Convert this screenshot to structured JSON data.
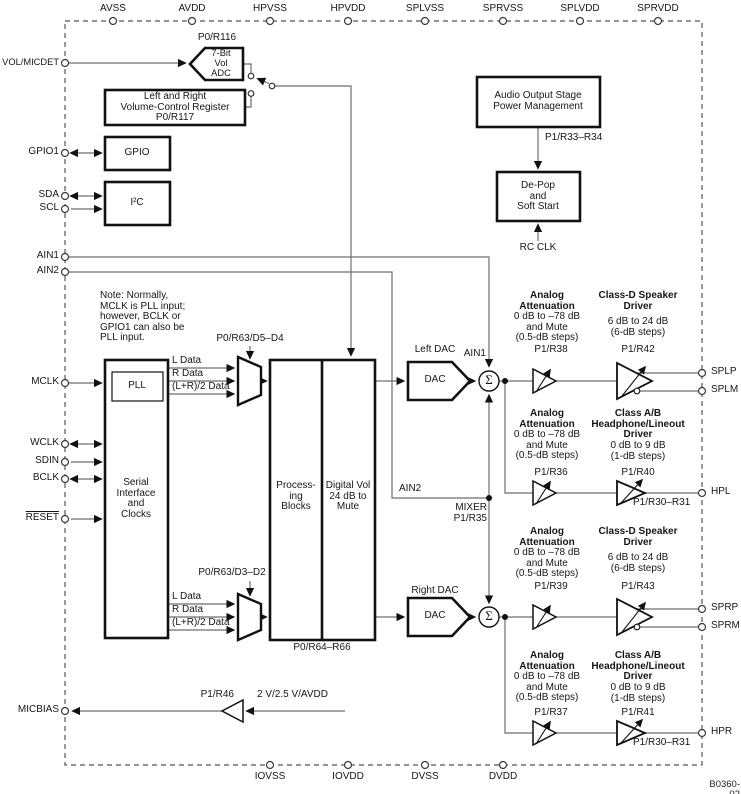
{
  "figure": {
    "id": "B0360-02"
  },
  "pins": {
    "top": [
      "AVSS",
      "AVDD",
      "HPVSS",
      "HPVDD",
      "SPLVSS",
      "SPRVSS",
      "SPLVDD",
      "SPRVDD"
    ],
    "bottom": [
      "IOVSS",
      "IOVDD",
      "DVSS",
      "DVDD"
    ],
    "left": {
      "vol_micdet": "VOL/MICDET",
      "gpio1": "GPIO1",
      "sda": "SDA",
      "scl": "SCL",
      "ain1": "AIN1",
      "ain2": "AIN2",
      "mclk": "MCLK",
      "wclk": "WCLK",
      "sdin": "SDIN",
      "bclk": "BCLK",
      "reset": "RESET",
      "micbias": "MICBIAS"
    },
    "right": {
      "splp": "SPLP",
      "splm": "SPLM",
      "hpl": "HPL",
      "sprp": "SPRP",
      "sprm": "SPRM",
      "hpr": "HPR"
    }
  },
  "blocks": {
    "vol_adc": {
      "reg": "P0/R116",
      "label": "7-Bit\nVol\nADC"
    },
    "vol_register": {
      "label": "Left and Right\nVolume-Control Register\nP0/R117"
    },
    "gpio": {
      "label": "GPIO"
    },
    "i2c": {
      "label": "I²C"
    },
    "audio_pm": {
      "label": "Audio Output Stage\nPower Management",
      "reg": "P1/R33–R34"
    },
    "depop": {
      "label": "De-Pop\nand\nSoft Start",
      "clock": "RC CLK"
    },
    "pll": {
      "label": "PLL"
    },
    "serial": {
      "label": "Serial\nInterface\nand\nClocks"
    },
    "processing": {
      "label": "Process-\ning\nBlocks"
    },
    "digital_vol": {
      "label": "Digital Vol\n24 dB to\nMute",
      "reg": "P0/R64–R66"
    },
    "left_dac": {
      "title": "Left DAC",
      "label": "DAC"
    },
    "right_dac": {
      "title": "Right DAC",
      "label": "DAC"
    },
    "mixer": {
      "label": "MIXER\nP1/R35",
      "sigma": "Σ"
    },
    "micbias_amp": {
      "reg": "P1/R46",
      "source": "2 V/2.5 V/AVDD"
    }
  },
  "muxes": {
    "top": {
      "reg": "P0/R63/D5–D4",
      "inputs": [
        "L Data",
        "R Data",
        "(L+R)/2 Data"
      ]
    },
    "bottom": {
      "reg": "P0/R63/D3–D2",
      "inputs": [
        "L Data",
        "R Data",
        "(L+R)/2 Data"
      ]
    }
  },
  "note": "Note: Normally,\nMCLK is PLL input;\nhowever, BCLK or\nGPIO1 can also be\nPLL input.",
  "signals": {
    "ain1": "AIN1",
    "ain2": "AIN2"
  },
  "channels": {
    "atten_title": "Analog\nAttenuation",
    "atten_range": "0 dB to –78 dB\nand Mute\n(0.5-dB steps)",
    "classd_title": "Class-D Speaker\nDriver",
    "classd_range": "6 dB to 24 dB\n(6-dB steps)",
    "classab_title": "Class A/B\nHeadphone/Lineout\nDriver",
    "classab_range": "0 dB to 9 dB\n(1-dB steps)",
    "classab_extra": "P1/R30–R31",
    "regs": {
      "r38": "P1/R38",
      "r42": "P1/R42",
      "r36": "P1/R36",
      "r40": "P1/R40",
      "r39": "P1/R39",
      "r43": "P1/R43",
      "r37": "P1/R37",
      "r41": "P1/R41"
    }
  },
  "colors": {
    "wire": "#6e6e6e",
    "ink": "#111111",
    "border_dash": "#555555"
  }
}
